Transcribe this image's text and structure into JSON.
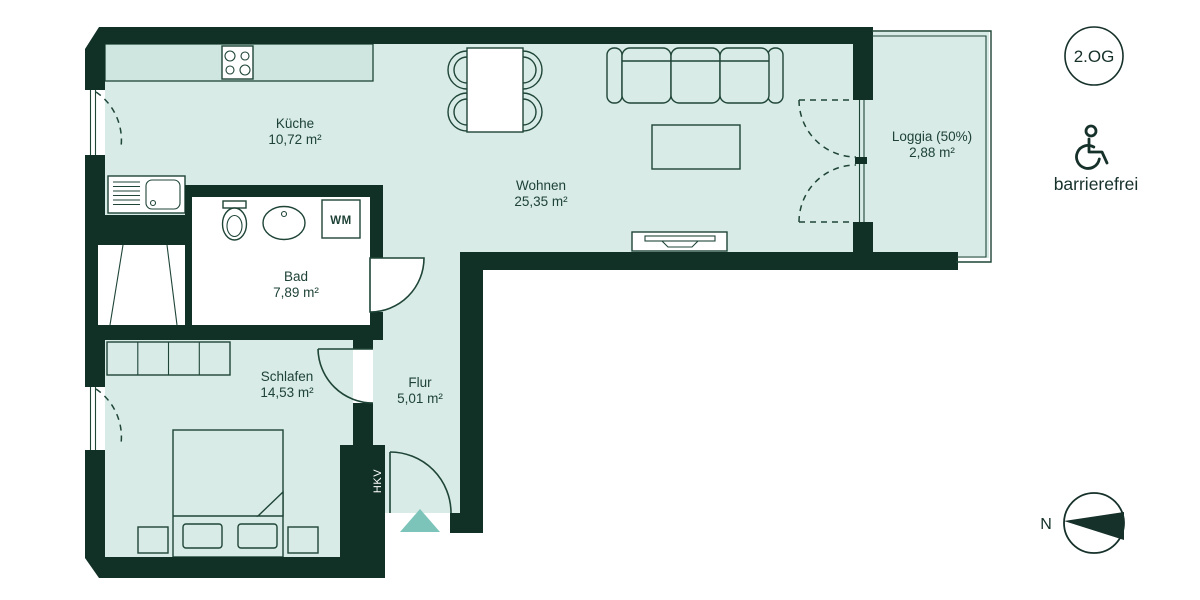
{
  "floorplan": {
    "floor_badge": "2.OG",
    "accessibility": "barrierefrei",
    "compass": "N",
    "hkv": "HKV",
    "washer": "WM",
    "rooms": [
      {
        "name": "Küche",
        "area": "10,72 m²"
      },
      {
        "name": "Wohnen",
        "area": "25,35 m²"
      },
      {
        "name": "Bad",
        "area": "7,89 m²"
      },
      {
        "name": "Schlafen",
        "area": "14,53 m²"
      },
      {
        "name": "Flur",
        "area": "5,01 m²"
      },
      {
        "name": "Loggia (50%)",
        "area": "2,88 m²"
      }
    ],
    "colors": {
      "wall": "#113126",
      "floor": "#d8ebe7",
      "bath_floor": "#ffffff",
      "counter": "#cfe6e0",
      "entrance_marker": "#7cc4ba",
      "outline": "#1f4537"
    }
  }
}
